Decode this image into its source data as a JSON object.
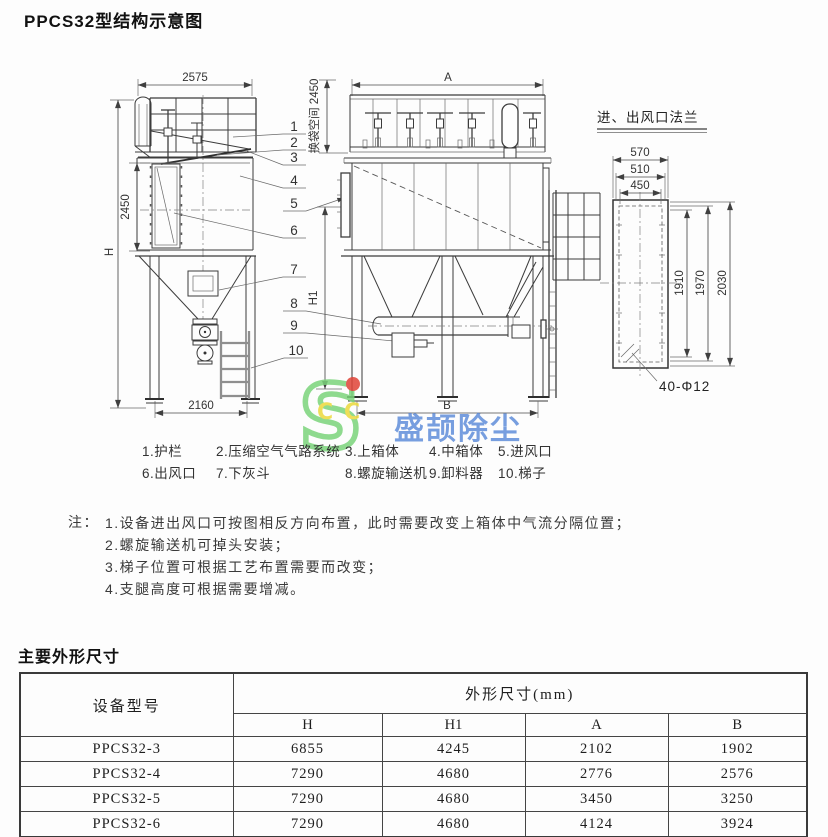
{
  "title": "PPCS32型结构示意图",
  "diagram": {
    "left_view": {
      "top_width": "2575",
      "mid_height": "2450",
      "total_height": "H",
      "base_width": "2160"
    },
    "front_view": {
      "top_width": "A",
      "inlet_height": "H1",
      "bag_space": "换袋空间 2450",
      "base_width": "B"
    },
    "callouts": [
      "1",
      "2",
      "3",
      "4",
      "5",
      "6",
      "7",
      "8",
      "9",
      "10"
    ],
    "flange_view": {
      "title": "进、出风口法兰",
      "width_dims": [
        "570",
        "510",
        "450"
      ],
      "height_dims": [
        "1910",
        "1970",
        "2030"
      ],
      "bolt_note": "40-Φ12"
    }
  },
  "watermark": {
    "logo_letter": "S",
    "logo_c1": "C",
    "logo_c2": "C",
    "brand_text": "盛颉除尘",
    "green": "#7bd47b",
    "yellow": "#ecd93c",
    "red": "#e04438",
    "blue": "#4f82d6"
  },
  "legend": {
    "items": [
      "1.护栏",
      "2.压缩空气气路系统",
      "3.上箱体",
      "4.中箱体",
      "5.进风口",
      "6.出风口",
      "7.下灰斗",
      "8.螺旋输送机",
      "9.卸料器",
      "10.梯子"
    ]
  },
  "notes": {
    "label": "注：",
    "items": [
      "1.设备进出风口可按图相反方向布置，此时需要改变上箱体中气流分隔位置；",
      "2.螺旋输送机可掉头安装；",
      "3.梯子位置可根据工艺布置需要而改变；",
      "4.支腿高度可根据需要增减。"
    ]
  },
  "dimensions_section": {
    "heading": "主要外形尺寸",
    "table": {
      "model_header": "设备型号",
      "group_header": "外形尺寸(mm)",
      "columns": [
        "H",
        "H1",
        "A",
        "B"
      ],
      "rows": [
        {
          "model": "PPCS32-3",
          "values": [
            "6855",
            "4245",
            "2102",
            "1902"
          ]
        },
        {
          "model": "PPCS32-4",
          "values": [
            "7290",
            "4680",
            "2776",
            "2576"
          ]
        },
        {
          "model": "PPCS32-5",
          "values": [
            "7290",
            "4680",
            "3450",
            "3250"
          ]
        },
        {
          "model": "PPCS32-6",
          "values": [
            "7290",
            "4680",
            "4124",
            "3924"
          ]
        }
      ]
    }
  }
}
